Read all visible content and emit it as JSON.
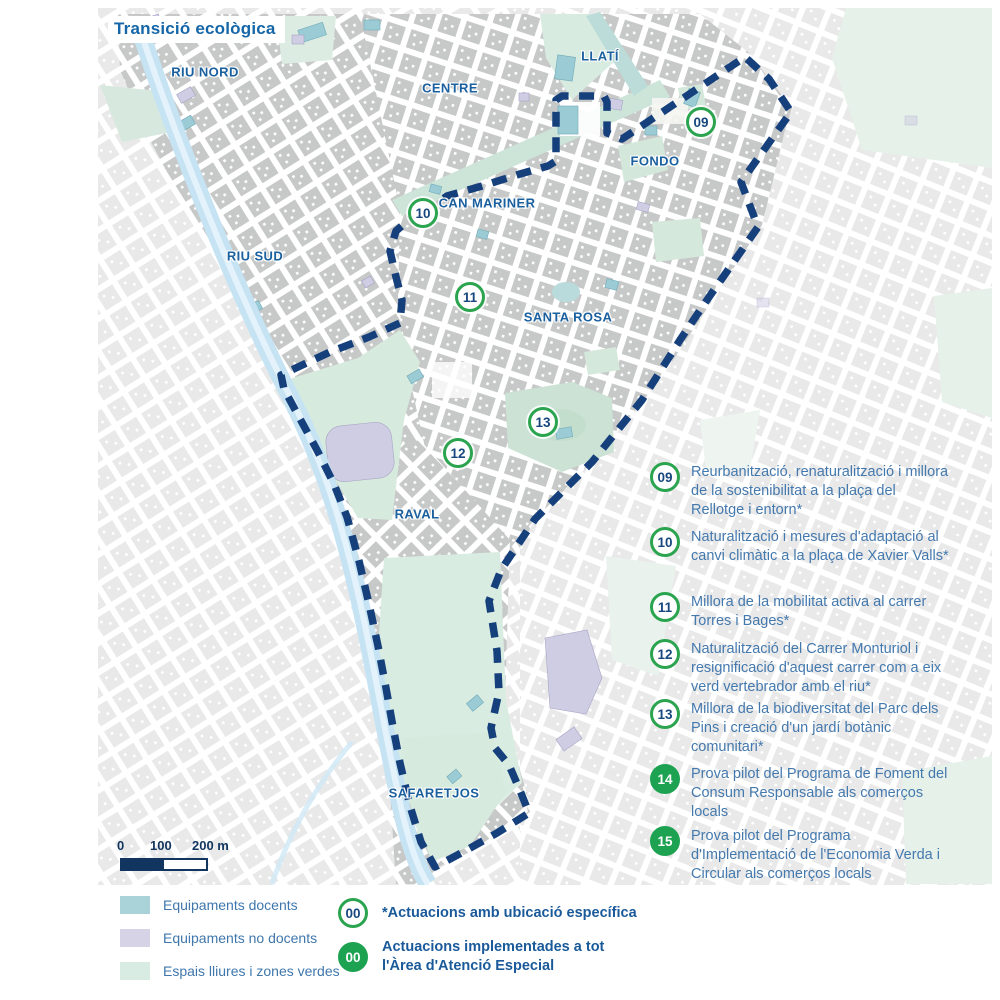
{
  "title": "Transició ecològica",
  "colors": {
    "boundary_navy": "#16407c",
    "label_blue": "#1a5f9e",
    "body_text_blue": "#4479ae",
    "marker_green_outline": "#2aa44e",
    "marker_green_filled": "#1ca251",
    "river_blue": "#c6e3f3"
  },
  "map": {
    "district_labels": [
      {
        "id": "riu-nord",
        "text": "RIU NORD"
      },
      {
        "id": "centre",
        "text": "CENTRE"
      },
      {
        "id": "llati",
        "text": "LLATÍ"
      },
      {
        "id": "fondo",
        "text": "FONDO"
      },
      {
        "id": "can-mariner",
        "text": "CAN MARINER"
      },
      {
        "id": "riu-sud",
        "text": "RIU SUD"
      },
      {
        "id": "santa-rosa",
        "text": "SANTA ROSA"
      },
      {
        "id": "raval",
        "text": "RAVAL"
      },
      {
        "id": "safaretjos",
        "text": "SAFARETJOS"
      }
    ],
    "markers": [
      {
        "number": "09"
      },
      {
        "number": "10"
      },
      {
        "number": "11"
      },
      {
        "number": "12"
      },
      {
        "number": "13"
      }
    ]
  },
  "actions": {
    "items": [
      {
        "number": "09",
        "type": "outline",
        "text": "Reurbanització, renaturalització i millora de la sostenibilitat a la plaça del Rellotge i entorn*"
      },
      {
        "number": "10",
        "type": "outline",
        "text": "Naturalització i mesures d'adaptació al canvi climàtic a la plaça de Xavier Valls*"
      },
      {
        "number": "11",
        "type": "outline",
        "text": "Millora de la mobilitat activa al carrer Torres i Bages*"
      },
      {
        "number": "12",
        "type": "outline",
        "text": "Naturalització del Carrer Monturiol i resignificació d'aquest carrer com a eix verd vertebrador amb el riu*"
      },
      {
        "number": "13",
        "type": "outline",
        "text": "Millora de la biodiversitat del Parc dels Pins i creació d'un jardí botànic comunitari*"
      },
      {
        "number": "14",
        "type": "filled",
        "text": "Prova pilot del Programa de Foment del Consum Responsable als comerços locals"
      },
      {
        "number": "15",
        "type": "filled",
        "text": "Prova pilot del Programa d'Implementació de l'Economia Verda i Circular als comerços locals"
      }
    ]
  },
  "scalebar": {
    "label_0": "0",
    "label_100": "100",
    "label_200": "200 m"
  },
  "legend": {
    "areas": [
      {
        "label": "Equipaments docents",
        "color": "#a9d2d9"
      },
      {
        "label": "Equipaments no docents",
        "color": "#d6d3e6"
      },
      {
        "label": "Espais lliures i zones verdes",
        "color": "#d9ece4"
      }
    ],
    "notes": [
      {
        "number": "00",
        "type": "outline",
        "label": "*Actuacions amb ubicació específica"
      },
      {
        "number": "00",
        "type": "filled",
        "label": "Actuacions implementades a tot l'Àrea d'Atenció Especial"
      }
    ]
  }
}
